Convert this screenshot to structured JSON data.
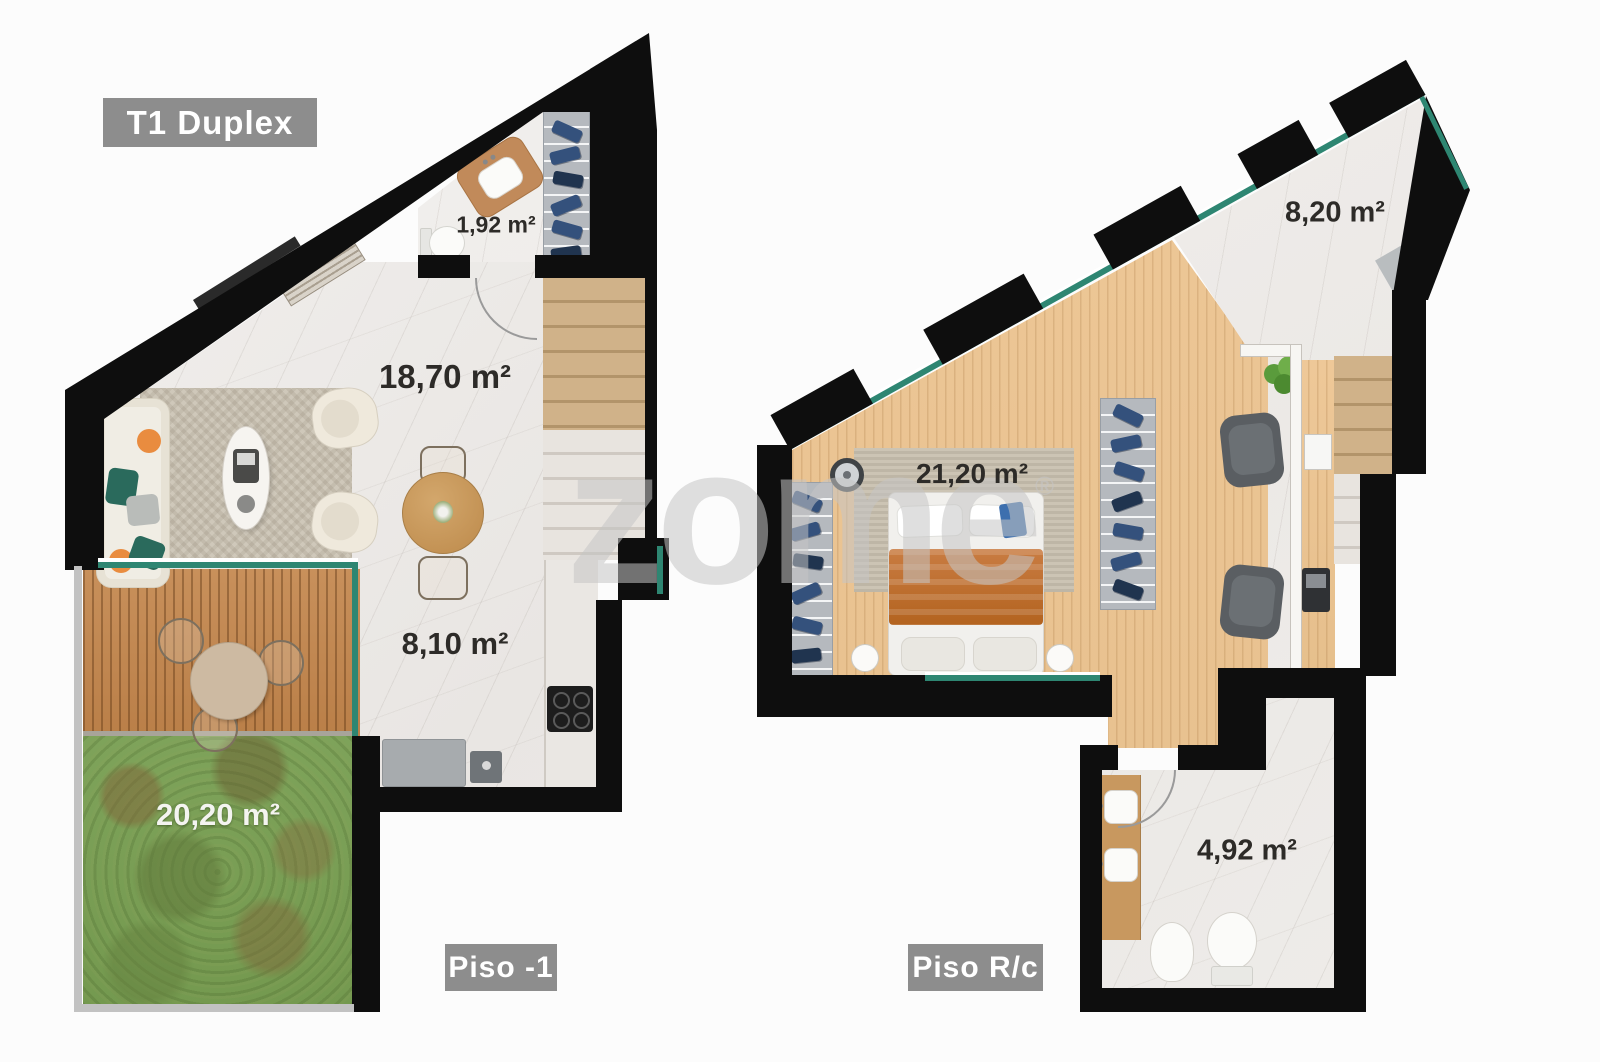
{
  "unit_badge": "T1 Duplex",
  "watermark": {
    "text": "zome",
    "reg": "®"
  },
  "plans": [
    {
      "id": "piso-1",
      "floor_badge": "Piso -1",
      "rooms": [
        {
          "key": "bathroom",
          "area_label": "1,92 m²"
        },
        {
          "key": "living-room",
          "area_label": "18,70 m²"
        },
        {
          "key": "kitchen",
          "area_label": "8,10 m²"
        },
        {
          "key": "garden",
          "area_label": "20,20 m²"
        }
      ]
    },
    {
      "id": "piso-rc",
      "floor_badge": "Piso R/c",
      "rooms": [
        {
          "key": "entry",
          "area_label": "8,20 m²"
        },
        {
          "key": "bedroom",
          "area_label": "21,20 m²"
        },
        {
          "key": "bathroom",
          "area_label": "4,92 m²"
        }
      ]
    }
  ],
  "colors": {
    "wall": "#0e0e0e",
    "glass": "#2e8672",
    "badge_bg": "#8d8d8d",
    "grass": "#7ea35a",
    "wood_floor": "#e8c292",
    "deck_wood": "#c0884f",
    "marble": "#efedea",
    "blanket_orange": "#c17238",
    "clothes_blue": "#34517c"
  }
}
